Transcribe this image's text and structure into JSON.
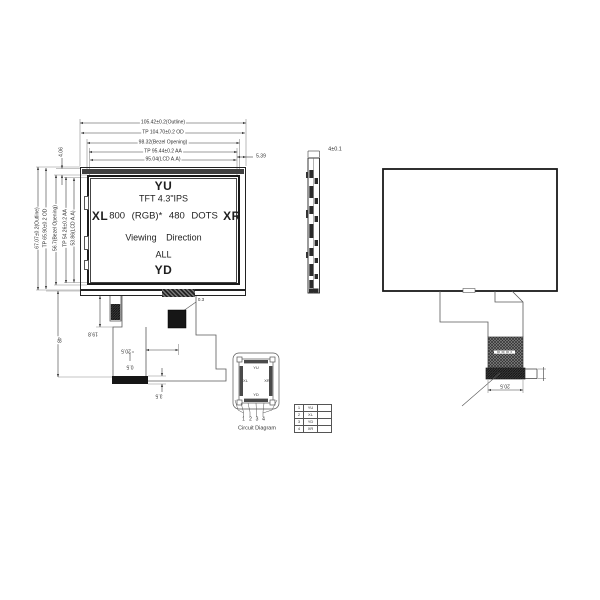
{
  "front_view": {
    "top_dims": {
      "outline": "105.42±0.2(Outline)",
      "tp_od": "TP 104.70±0.2 OD",
      "bezel": "98.32(Bezel Opening)",
      "tp_aa": "TP 95.44±0.2 AA",
      "lcd_aa": "95.04(LCD A.A)",
      "right_offset": "5.39"
    },
    "left_dims": {
      "outline": "67.07±0.2(Outline)",
      "tp_od": "TP 65.90±0.2 OD",
      "bezel": "56.7(Bezel Opening)",
      "tp_aa": "TP 54.26±0.2 AA",
      "lcd_aa": "53.86(LCD A.A)",
      "top_offset": "4.06"
    },
    "screen": {
      "top_electrode": "YU",
      "bottom_electrode": "YD",
      "left_electrode": "XL",
      "right_electrode": "XR",
      "line1": "TFT 4.3\"IPS",
      "line2": "800 (RGB)* 480 DOTS",
      "line3": "Viewing Direction",
      "line4": "ALL"
    },
    "fpc_dims": {
      "tail_offset": "19.8",
      "width": "20.5",
      "stiffener": "0.5",
      "connector_height": "3.5",
      "length": "48",
      "fold": "0.3"
    }
  },
  "side_view": {
    "thickness": "4±0.1"
  },
  "back_view": {
    "fpc_width": "20.5"
  },
  "circuit_diagram": {
    "caption": "Circuit Diagram",
    "electrodes": {
      "top": "YU",
      "bottom": "YD",
      "left": "XL",
      "right": "XR"
    },
    "pins": [
      "1",
      "2",
      "3",
      "4"
    ],
    "pin_table": {
      "rows": [
        {
          "pin": "1",
          "signal": "YU"
        },
        {
          "pin": "2",
          "signal": "XL"
        },
        {
          "pin": "3",
          "signal": "YD"
        },
        {
          "pin": "4",
          "signal": "XR"
        }
      ]
    }
  },
  "colors": {
    "line": "#333333",
    "dark_fill": "#1c1c1c",
    "hatch_gray": "#6b6b6b",
    "background": "#ffffff"
  }
}
